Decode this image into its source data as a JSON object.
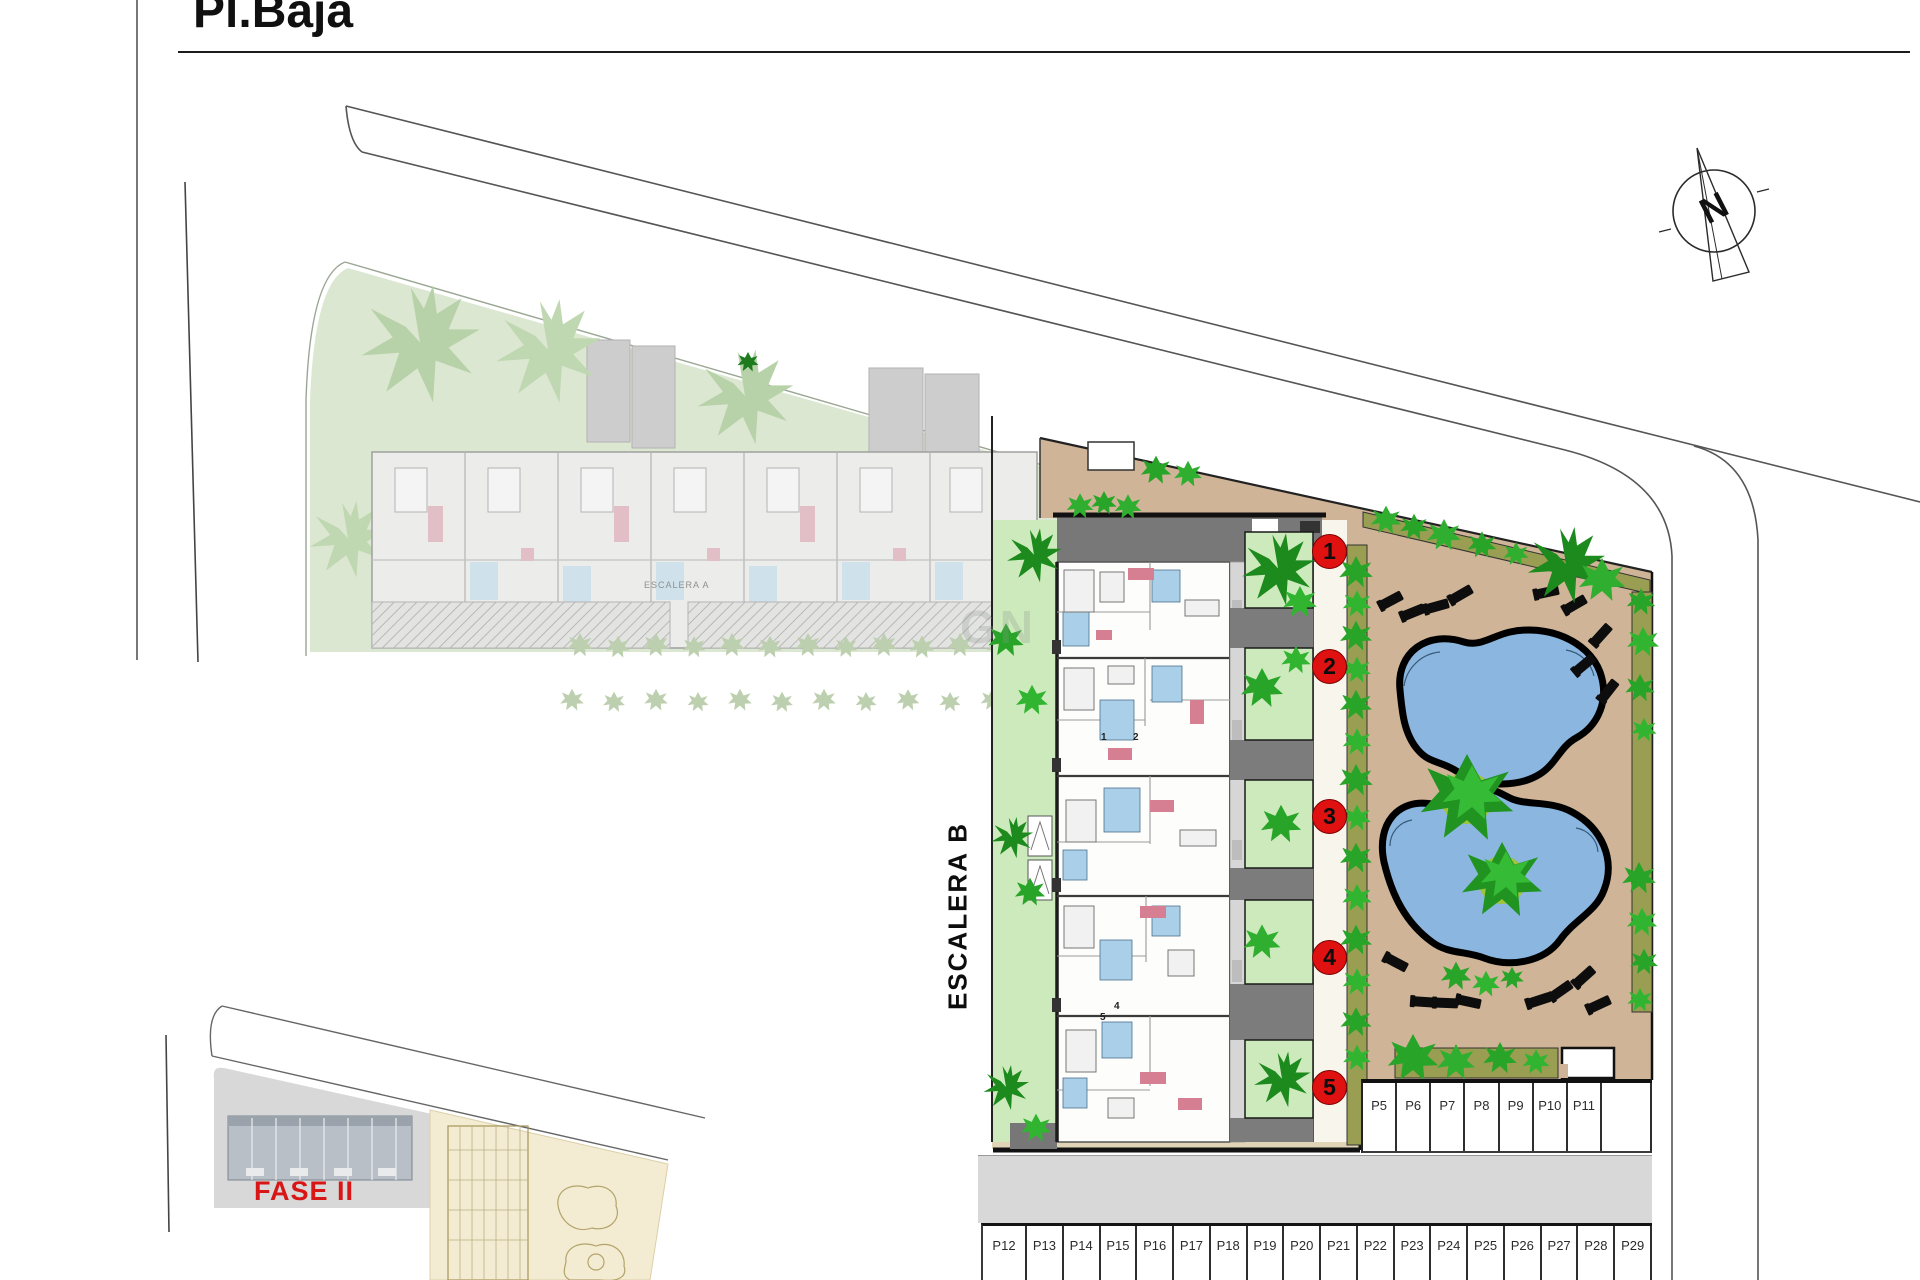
{
  "page": {
    "title": "Pl.Baja"
  },
  "compass": {
    "north_label": "N"
  },
  "watermark": {
    "text": "GN"
  },
  "phase2": {
    "label": "FASE II",
    "escalera_label": "ESCALERA A"
  },
  "building_b": {
    "escalera_label": "ESCALERA B",
    "unit_markers": [
      "1",
      "2",
      "3",
      "4",
      "5"
    ],
    "room_numbers": [
      "1",
      "2",
      "4",
      "5"
    ]
  },
  "parking": {
    "row_east": [
      "P5",
      "P6",
      "P7",
      "P8",
      "P9",
      "P10",
      "P11"
    ],
    "row_south": [
      "P12",
      "P13",
      "P14",
      "P15",
      "P16",
      "P17",
      "P18",
      "P19",
      "P20",
      "P21",
      "P22",
      "P23",
      "P24",
      "P25",
      "P26",
      "P27",
      "P28",
      "P29"
    ]
  }
}
